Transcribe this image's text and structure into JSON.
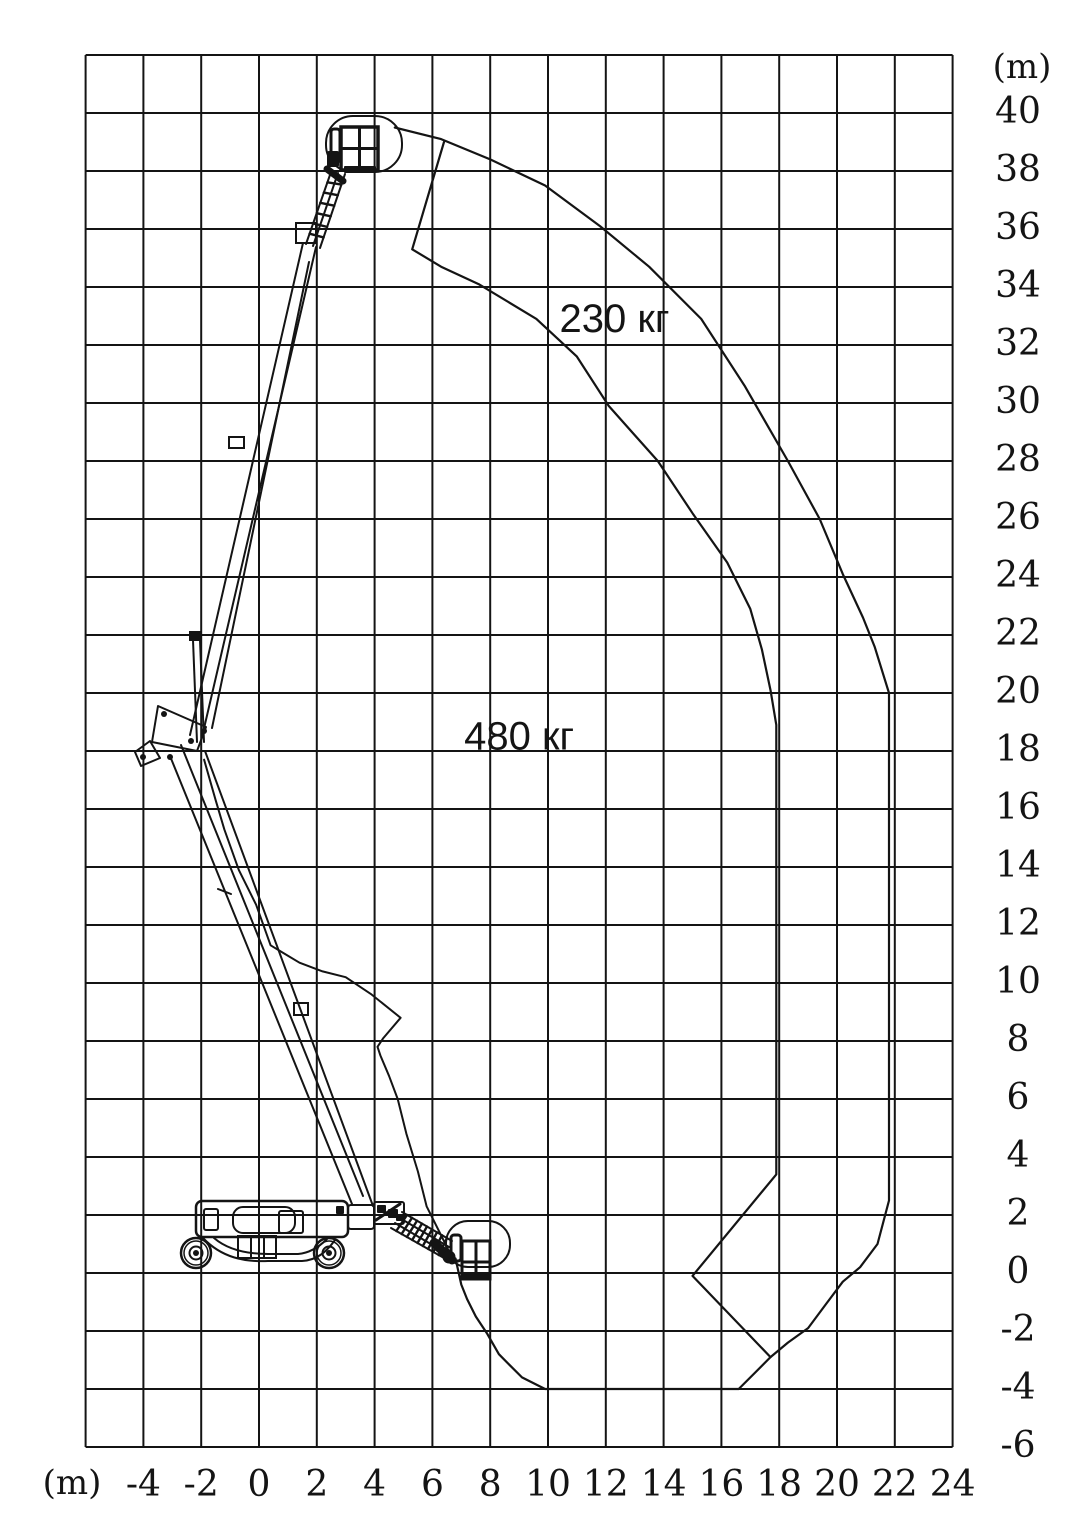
{
  "page": {
    "background": "#ffffff",
    "ink": "#141414"
  },
  "axes": {
    "y": {
      "unit": "(m)",
      "values": [
        40,
        38,
        36,
        34,
        32,
        30,
        28,
        26,
        24,
        22,
        20,
        18,
        16,
        14,
        12,
        10,
        8,
        6,
        4,
        2,
        0,
        -2,
        -4,
        -6
      ],
      "labels": [
        "40",
        "38",
        "36",
        "34",
        "32",
        "30",
        "28",
        "26",
        "24",
        "22",
        "20",
        "18",
        "16",
        "14",
        "12",
        "10",
        "8",
        "6",
        "4",
        "2",
        "0",
        "-2",
        "-4",
        "-6"
      ]
    },
    "x": {
      "unit": "(m)",
      "values": [
        -4,
        -2,
        0,
        2,
        4,
        6,
        8,
        10,
        12,
        14,
        16,
        18,
        20,
        22,
        24
      ],
      "labels": [
        "-4",
        "-2",
        "0",
        "2",
        "4",
        "6",
        "8",
        "10",
        "12",
        "14",
        "16",
        "18",
        "20",
        "22",
        "24"
      ]
    }
  },
  "chart_data": {
    "type": "area",
    "units": "m",
    "grid": true,
    "grid_step": 2,
    "axis_ranges": {
      "x": [
        -6,
        24
      ],
      "y": [
        -6,
        42
      ]
    },
    "zones": [
      {
        "label": "230 кг",
        "capacity_kg": 230,
        "label_pos_m": [
          12.3,
          32.9
        ],
        "boundary_m": [
          [
            4.7,
            39.5
          ],
          [
            6.3,
            39.1
          ],
          [
            8.0,
            38.4
          ],
          [
            9.9,
            37.5
          ],
          [
            11.8,
            36.1
          ],
          [
            13.5,
            34.7
          ],
          [
            15.3,
            32.9
          ],
          [
            16.8,
            30.6
          ],
          [
            18.3,
            28.0
          ],
          [
            19.4,
            26.0
          ],
          [
            20.2,
            24.1
          ],
          [
            20.9,
            22.6
          ],
          [
            21.3,
            21.6
          ],
          [
            21.8,
            20.0
          ],
          [
            21.8,
            2.5
          ],
          [
            21.4,
            1.0
          ],
          [
            20.8,
            0.2
          ],
          [
            20.2,
            -0.3
          ],
          [
            19.6,
            -1.1
          ],
          [
            19.0,
            -1.9
          ],
          [
            18.3,
            -2.4
          ],
          [
            17.7,
            -2.9
          ],
          [
            17.2,
            -3.4
          ],
          [
            16.6,
            -4.0
          ],
          [
            9.9,
            -4.0
          ],
          [
            9.1,
            -3.6
          ],
          [
            8.7,
            -3.2
          ],
          [
            8.3,
            -2.8
          ],
          [
            7.9,
            -2.1
          ],
          [
            7.5,
            -1.5
          ],
          [
            7.2,
            -0.9
          ],
          [
            7.0,
            -0.4
          ],
          [
            6.8,
            0.5
          ]
        ]
      },
      {
        "label": "480 кг",
        "capacity_kg": 480,
        "label_pos_m": [
          9.0,
          18.5
        ],
        "boundary_m": [
          [
            6.4,
            39.0
          ],
          [
            5.3,
            35.3
          ],
          [
            6.3,
            34.7
          ],
          [
            7.6,
            34.1
          ],
          [
            9.6,
            32.9
          ],
          [
            11.0,
            31.6
          ],
          [
            12.1,
            29.9
          ],
          [
            13.8,
            28.0
          ],
          [
            15.0,
            26.2
          ],
          [
            16.2,
            24.5
          ],
          [
            17.0,
            22.9
          ],
          [
            17.4,
            21.5
          ],
          [
            17.7,
            20.1
          ],
          [
            17.9,
            18.9
          ],
          [
            17.9,
            3.4
          ],
          [
            15.0,
            -0.1
          ],
          [
            17.7,
            -2.9
          ]
        ]
      }
    ],
    "machine_side_boundary_m": [
      [
        -1.9,
        17.7
      ],
      [
        -1.5,
        16.3
      ],
      [
        -1.2,
        15.3
      ],
      [
        -0.7,
        13.9
      ],
      [
        -0.1,
        12.7
      ],
      [
        0.4,
        11.3
      ],
      [
        0.9,
        11.0
      ],
      [
        1.4,
        10.7
      ],
      [
        2.2,
        10.4
      ],
      [
        3.0,
        10.2
      ],
      [
        3.9,
        9.6
      ],
      [
        4.9,
        8.8
      ],
      [
        4.3,
        8.1
      ],
      [
        4.1,
        7.8
      ],
      [
        4.2,
        7.5
      ],
      [
        4.5,
        6.8
      ],
      [
        4.8,
        6.0
      ],
      [
        5.1,
        4.8
      ],
      [
        5.5,
        3.5
      ],
      [
        5.8,
        2.3
      ],
      [
        6.3,
        1.3
      ],
      [
        6.6,
        0.7
      ]
    ]
  }
}
